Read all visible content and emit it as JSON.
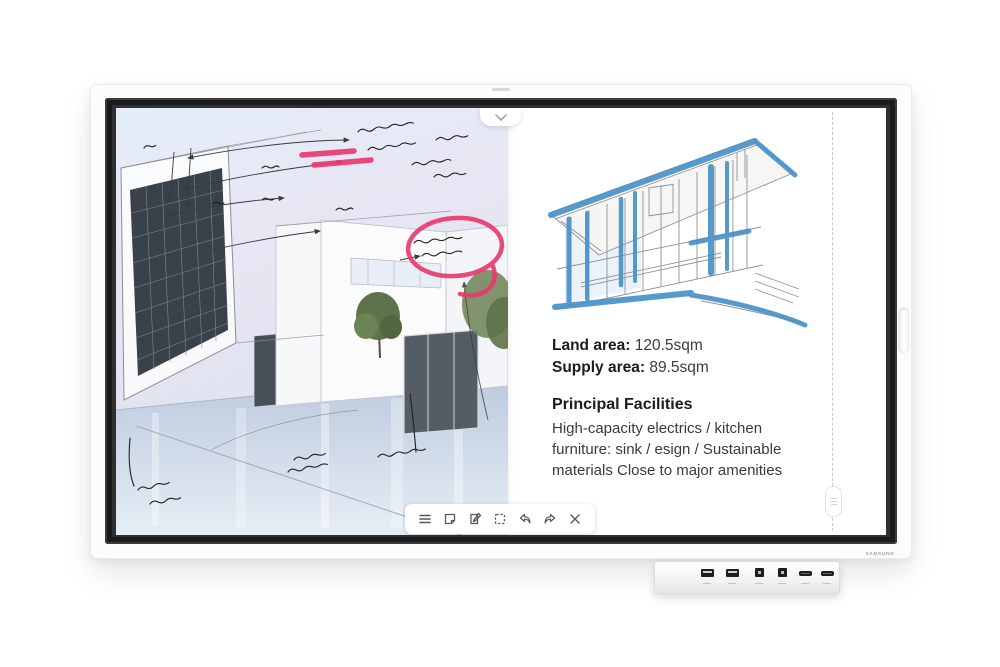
{
  "device": {
    "brand": "SAMSUNG",
    "model_hint": "interactive flip display"
  },
  "right_page": {
    "land_area_label": "Land area:",
    "land_area_value": "120.5sqm",
    "supply_area_label": "Supply area:",
    "supply_area_value": "89.5sqm",
    "facilities_title": "Principal Facilities",
    "facilities_body": "High-capacity electrics / kitchen furniture: sink / esign / Sustainable materials Close to major amenities"
  },
  "toolbar": {
    "icons": [
      {
        "name": "menu-icon",
        "glyph": "≡"
      },
      {
        "name": "note-icon",
        "glyph": "🗎"
      },
      {
        "name": "paste-import-icon",
        "glyph": "📋"
      },
      {
        "name": "select-icon",
        "glyph": "⬚"
      },
      {
        "name": "undo-icon",
        "glyph": "↩"
      },
      {
        "name": "redo-icon",
        "glyph": "↪"
      },
      {
        "name": "close-icon",
        "glyph": "✕"
      }
    ]
  },
  "panel_controls": {
    "top_toggle": "chevron-down",
    "page_divider": "dashed-line-with-handle"
  },
  "ports": [
    "usb-a-port",
    "usb-a-port",
    "usb-b-port",
    "usb-b-port",
    "hdmi-port",
    "hdmi-port"
  ],
  "colors": {
    "annotation_pink": "#e93a6e",
    "annotation_blue": "#478fc8",
    "bezel": "#1b1b1b",
    "chassis": "#fcfcfc",
    "toolbar_icon": "#585858"
  }
}
